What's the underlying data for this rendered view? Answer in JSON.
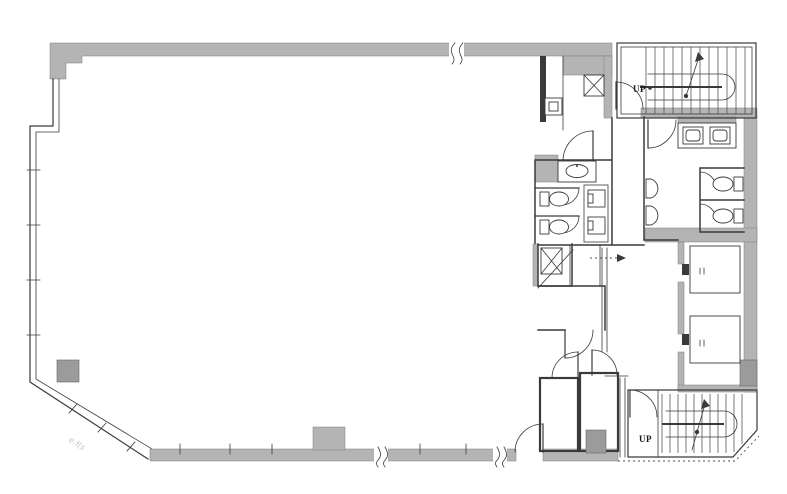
{
  "plan": {
    "kind": "building-floor-plan",
    "labels": {
      "stair_upper": "UP",
      "stair_lower": "UP",
      "wall_annotation": "e.f(s"
    },
    "colors": {
      "background": "#ffffff",
      "wall_fill": "#b4b4b4",
      "wall_dark": "#9b9b9b",
      "line": "#3a3a3a",
      "annotation": "#c4c4c4"
    },
    "features": [
      "open-office-area",
      "upper-staircase",
      "lower-staircase",
      "elevator-bank",
      "restroom-left",
      "restroom-right",
      "pipe-shaft",
      "duct-shaft",
      "mop-closet",
      "service-rooms",
      "window-walls",
      "structural-columns"
    ]
  }
}
